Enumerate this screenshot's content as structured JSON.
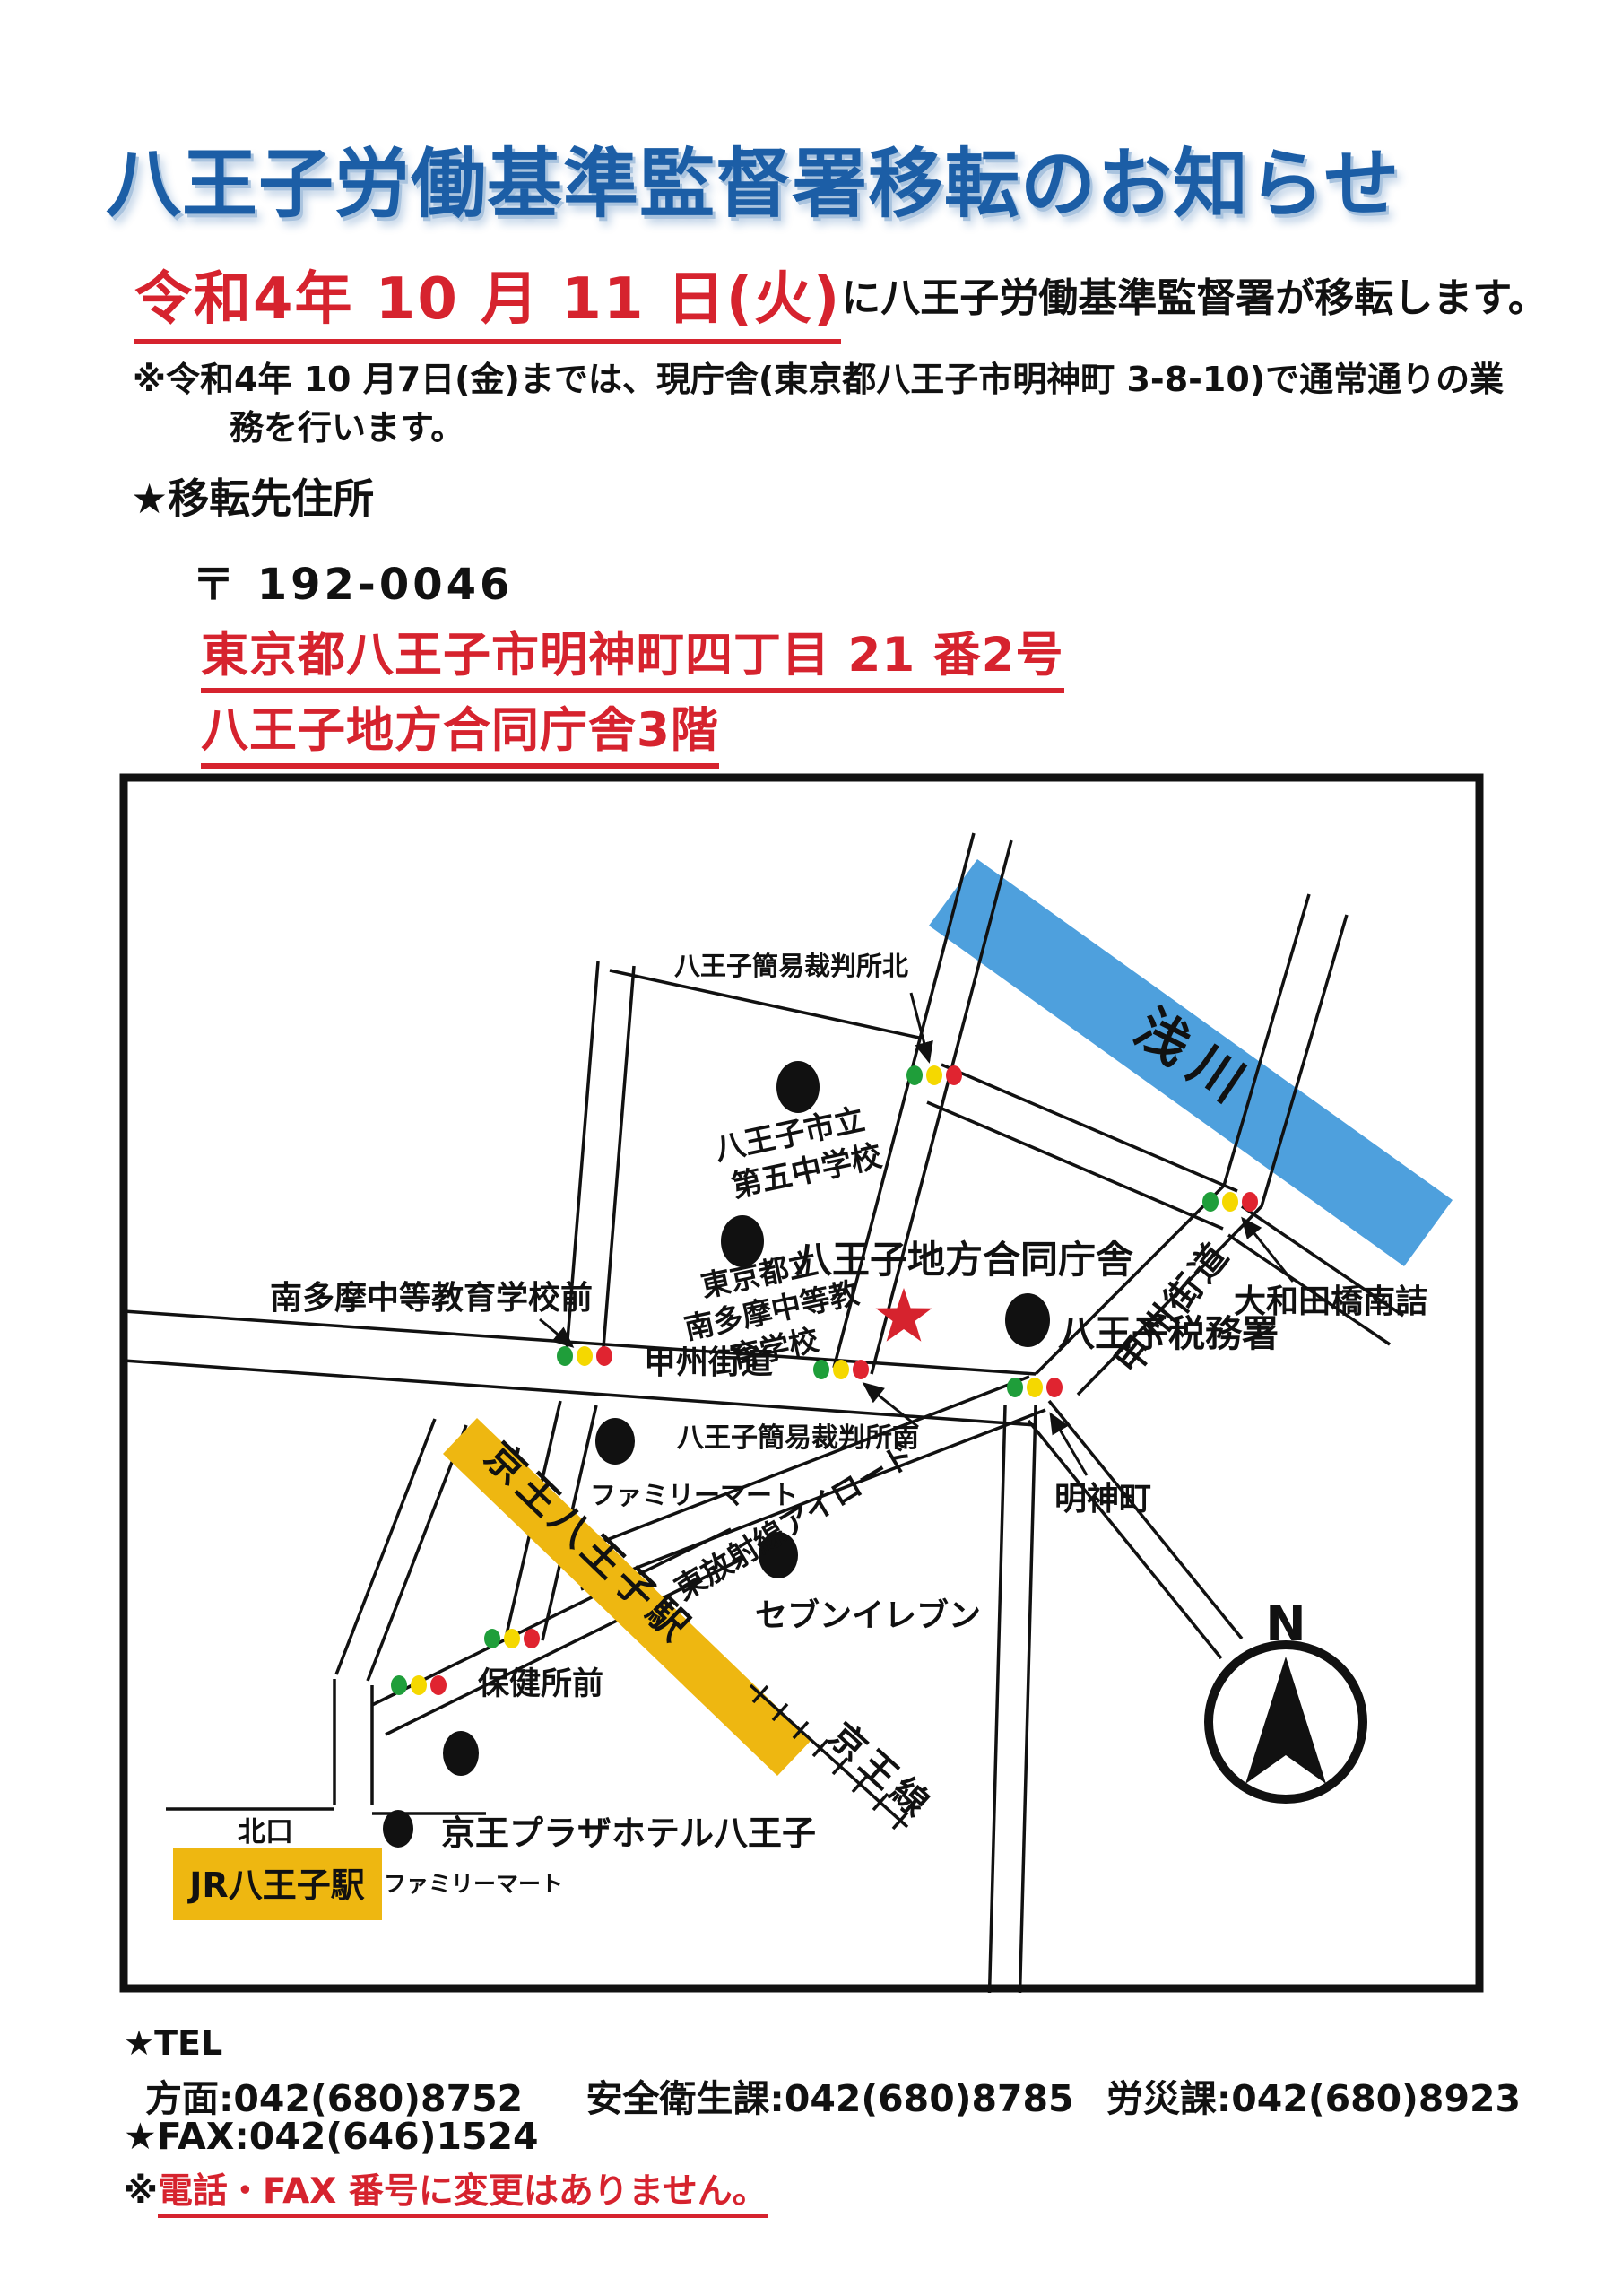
{
  "header": {
    "title": "八王子労働基準監督署移転のお知らせ",
    "date": "令和4年 10 月 11 日(火)",
    "date_suffix": "に八王子労働基準監督署が移転します。",
    "note_line1": "※令和4年 10 月7日(金)までは、現庁舎(東京都八王子市明神町 3-8-10)で通常通りの業",
    "note_line2": "務を行います。",
    "relocation_heading": "★移転先住所",
    "postal_code": "〒 192-0046",
    "address_line1": "東京都八王子市明神町四丁目 21 番2号",
    "address_line2": "八王子地方合同庁舎3階"
  },
  "map": {
    "river": "浅川",
    "compass": "N",
    "office_red": "八王子地方合同庁舎",
    "tax_office": "八王子税務署",
    "court_north": "八王子簡易裁判所北",
    "court_south": "八王子簡易裁判所南",
    "school1_l1": "八王子市立",
    "school1_l2": "第五中学校",
    "school2_l1": "東京都立",
    "school2_l2": "南多摩中等教",
    "school2_l3": "育学校",
    "school_stop": "南多摩中等教育学校前",
    "koshu_kaido_w": "甲州街道",
    "koshu_kaido_ne": "甲州街道",
    "owada_bridge": "大和田橋南詰",
    "myojincho": "明神町",
    "airoad": "東放射線アイロード",
    "familymart1": "ファミリーマート",
    "seven_eleven": "セブンイレブン",
    "hokenjo_mae": "保健所前",
    "keio_plaza": "京王プラザホテル八王子",
    "familymart2": "ファミリーマート",
    "kitaguchi": "北口",
    "jr_station": "JR八王子駅",
    "keio_station": "京王八王子駅",
    "keio_line": "京王線"
  },
  "contact": {
    "tel_heading": "★TEL",
    "tel_items": [
      "方面:042(680)8752",
      "安全衛生課:042(680)8785",
      "労災課:042(680)8923"
    ],
    "fax": "★FAX:042(646)1524",
    "note_prefix": "※",
    "note": "電話・FAX 番号に変更はありません。"
  },
  "colors": {
    "title_blue": "#1c5ea6",
    "accent_red": "#d6232e",
    "river_blue": "#4ea0dd",
    "station_yellow": "#eeb711",
    "signal_green": "#1f9e3a",
    "signal_yellow": "#f5d800",
    "signal_red": "#e02430",
    "ink_black": "#111111"
  }
}
